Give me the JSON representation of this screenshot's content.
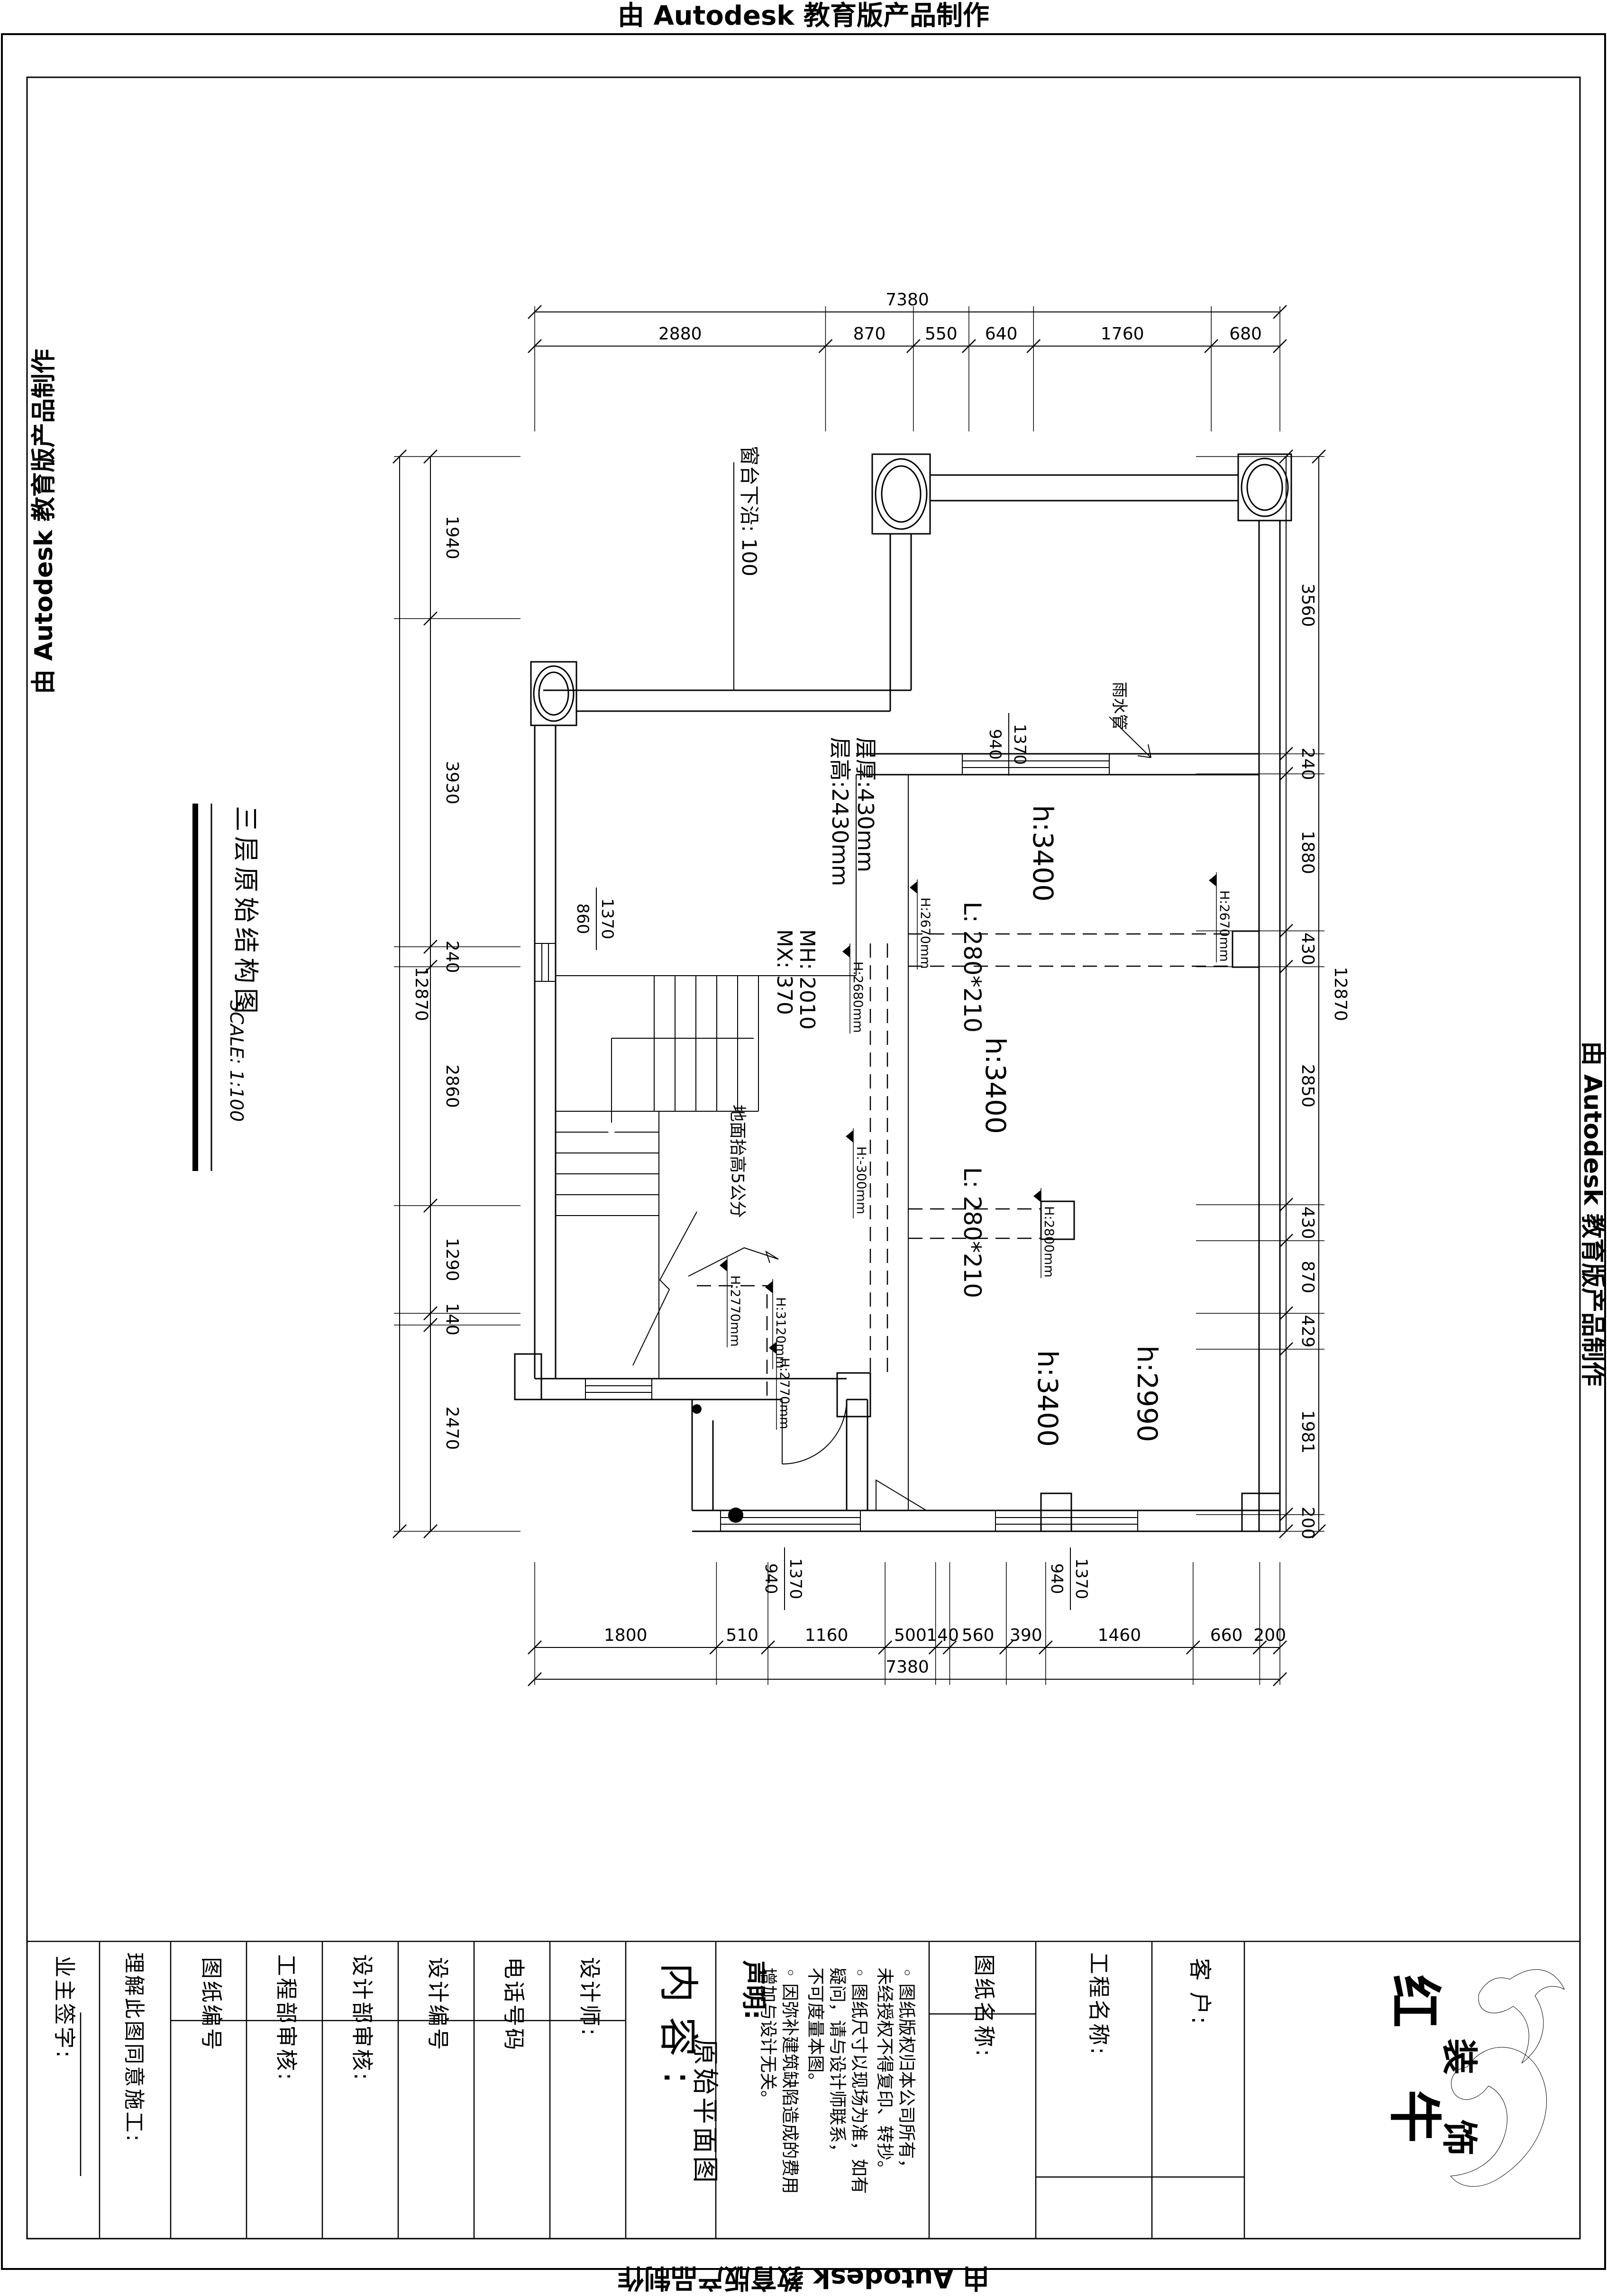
{
  "edge_stamp": {
    "top": "由 Autodesk 教育版产品制作",
    "bottom": "由 Autodesk 教育版产品制作",
    "left": "由 Autodesk 教育版产品制作",
    "right": "由 Autodesk 教育版产品制作"
  },
  "drawing_title": {
    "name": "三层原始结构图",
    "scale": "SCALE: 1:100"
  },
  "dims": {
    "top": {
      "total": "7380",
      "segments": [
        "2880",
        "870",
        "550",
        "640",
        "1760",
        "680"
      ]
    },
    "bottom": {
      "total": "7380",
      "segments": [
        "1800",
        "510",
        "1160",
        "500",
        "140",
        "560",
        "390",
        "1460",
        "660",
        "200"
      ]
    },
    "left": {
      "total": "12870",
      "segments": [
        "1940",
        "3930",
        "240",
        "2860",
        "1290",
        "140",
        "2470"
      ]
    },
    "right": {
      "total": "12870",
      "segments": [
        "3560",
        "240",
        "1880",
        "430",
        "2850",
        "430",
        "870",
        "429",
        "1981",
        "200"
      ]
    }
  },
  "plan": {
    "rooms": [
      {
        "label": "h:3400"
      },
      {
        "label": "h:3400"
      },
      {
        "label": "h:3400"
      },
      {
        "label": "h:2990"
      }
    ],
    "beams": [
      {
        "label": "L: 280*210"
      },
      {
        "label": "L: 280*210"
      }
    ],
    "levels": [
      {
        "label": "H:2670mm"
      },
      {
        "label": "H:2670mm"
      },
      {
        "label": "H:2680mm"
      },
      {
        "label": "H:-300mm"
      },
      {
        "label": "H:2800mm"
      },
      {
        "label": "H:2770mm"
      },
      {
        "label": "H:3120mm"
      },
      {
        "label": "H:2770mm"
      }
    ],
    "window_labels": [
      {
        "w": "1370",
        "h": "940"
      },
      {
        "w": "1370",
        "h": "860"
      },
      {
        "w": "1370",
        "h": "940"
      },
      {
        "w": "1370",
        "h": "940"
      }
    ],
    "annotations": {
      "sill": "窗台下沿: 100",
      "rain_pipe": "雨水管",
      "slab_thickness": "层厚:430mm",
      "slab_height": "层高:2430mm",
      "door_mh": "MH: 2010",
      "door_mx": "MX: 370",
      "floor_raise": "地面抬高5公分"
    }
  },
  "titleblock": {
    "owner_sign": "业主签字:",
    "agree": "理解此图同意施工:",
    "drawing_no": "图纸编号",
    "eng_audit": "工程部审核:",
    "design_audit": "设计部审核:",
    "design_no": "设计编号",
    "phone": "电话号码",
    "designer": "设计师:",
    "content_label": "内容:",
    "content_value": "原始平面图",
    "statement_title": "声明:",
    "statement_lines": [
      "◦ 图纸版权归本公司所有，",
      "未经授权不得复印、转抄。",
      "◦ 图纸尺寸以现场为准，如有",
      "疑问，请与设计师联系，",
      "不可度量本图。",
      "◦ 因弥补建筑缺陷造成的费用",
      "增加与设计无关。"
    ],
    "drawing_name_label": "图纸名称:",
    "project_name_label": "工程名称:",
    "client_label": "客  户:",
    "brand_1": "红 牛",
    "brand_2": "装 饰"
  }
}
